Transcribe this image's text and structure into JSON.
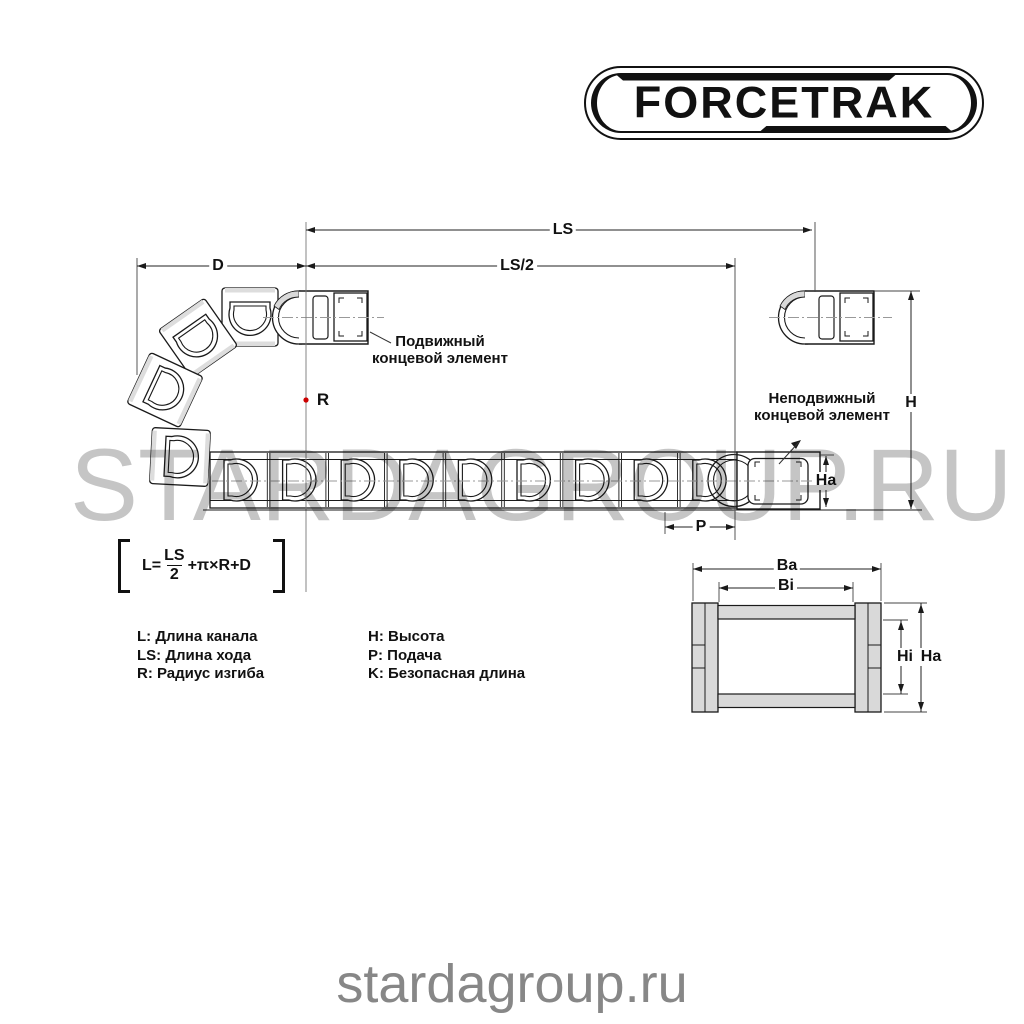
{
  "brand": {
    "logo_text": "FORCETRAK"
  },
  "watermark": {
    "large": "STARDAGROUP.RU",
    "small": "stardagroup.ru"
  },
  "diagram": {
    "dimensions": {
      "ls": "LS",
      "ls_half": "LS/2",
      "d": "D",
      "r": "R",
      "h": "H",
      "ha": "Ha",
      "p": "P"
    },
    "annotations": {
      "movable_line1": "Подвижный",
      "movable_line2": "концевой элемент",
      "fixed_line1": "Неподвижный",
      "fixed_line2": "концевой элемент"
    },
    "formula": {
      "lhs": "L=",
      "numerator": "LS",
      "denominator": "2",
      "tail": "+π×R+D"
    },
    "legend": {
      "left": [
        "L: Длина канала",
        "LS: Длина хода",
        "R: Радиус изгиба"
      ],
      "right": [
        "H: Высота",
        "P: Подача",
        "K: Безопасная длина"
      ]
    },
    "cross_section": {
      "ba": "Ba",
      "bi": "Bi",
      "hi": "Hi",
      "ha": "Ha"
    }
  },
  "colors": {
    "line": "#1a1a1a",
    "gray_fill": "#d9d9d9",
    "watermark_large": "#c8c8c8",
    "watermark_small": "#878787",
    "red_dot": "#cc0000"
  }
}
